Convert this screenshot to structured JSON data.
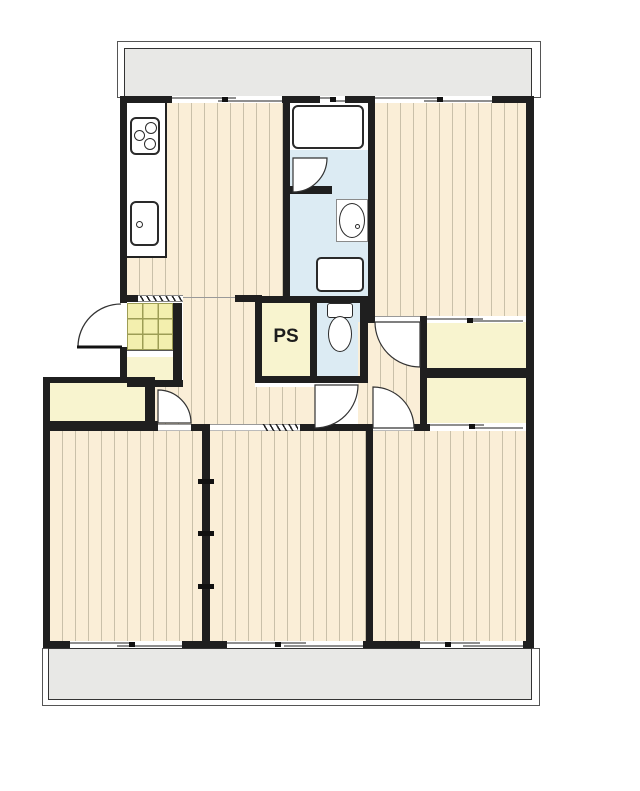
{
  "plan": {
    "pipe_space_label": "PS",
    "colors": {
      "wall": "#1f1f1f",
      "floor": "#faeed7",
      "floor_stripe": "#c9c0a9",
      "service_yellow": "#f8f4cf",
      "entry_tile": "#f3efae",
      "entry_tile_line": "#9d9d55",
      "wet_blue": "#dcebf3",
      "balcony_gray": "#e8e8e6"
    },
    "fixtures": [
      "gas-stove-icon",
      "kitchen-sink-icon",
      "bathtub-icon",
      "washbasin-icon",
      "washing-machine-pan-icon",
      "toilet-icon"
    ]
  }
}
